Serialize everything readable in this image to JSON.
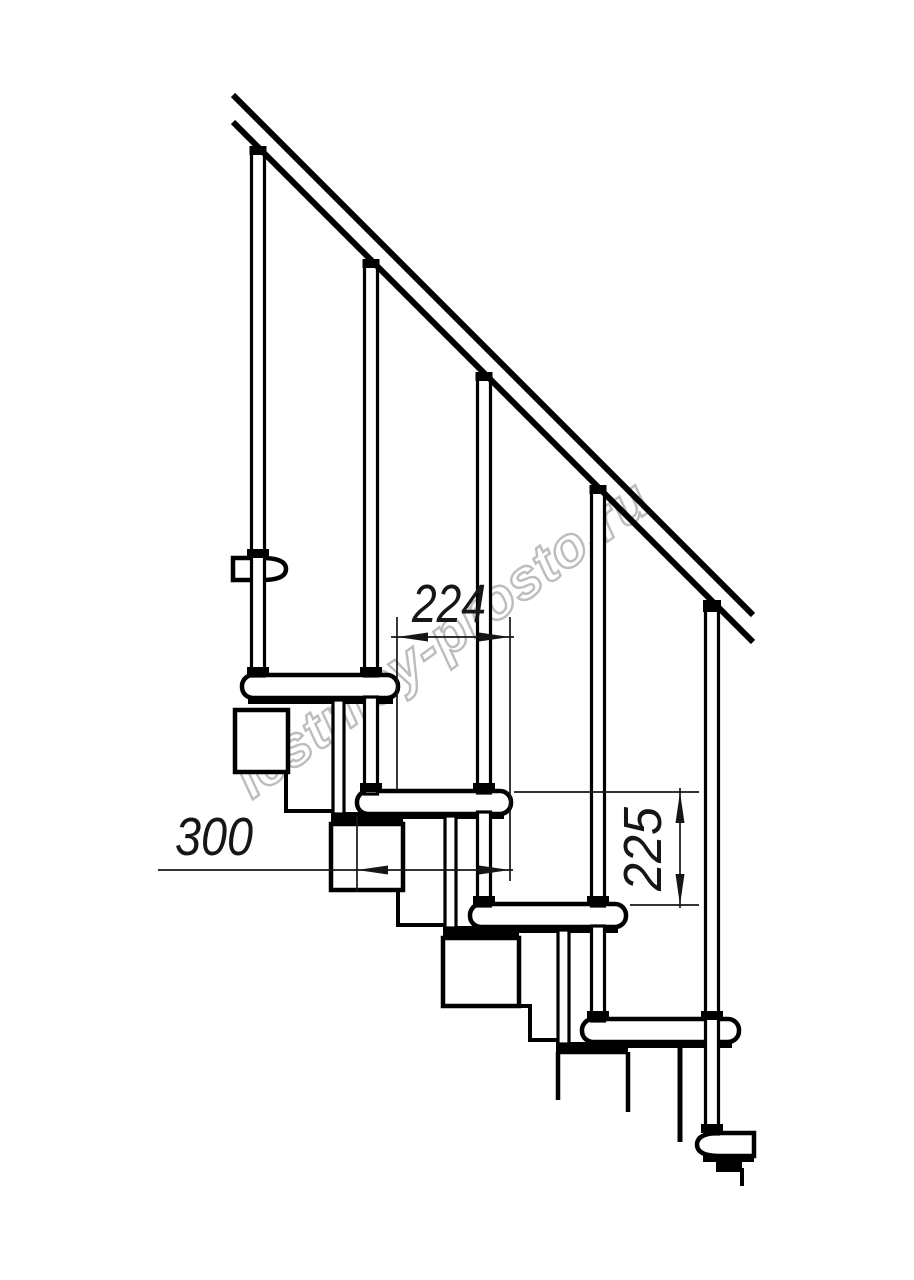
{
  "watermark": {
    "text": "lestnicy-prosto.ru",
    "color": "#bdbdbd"
  },
  "dimensions": {
    "step_offset": "224",
    "tread_depth": "300",
    "step_rise": "225"
  },
  "drawing": {
    "line_color": "#000000",
    "dim_color": "#161616",
    "background": "#ffffff"
  }
}
